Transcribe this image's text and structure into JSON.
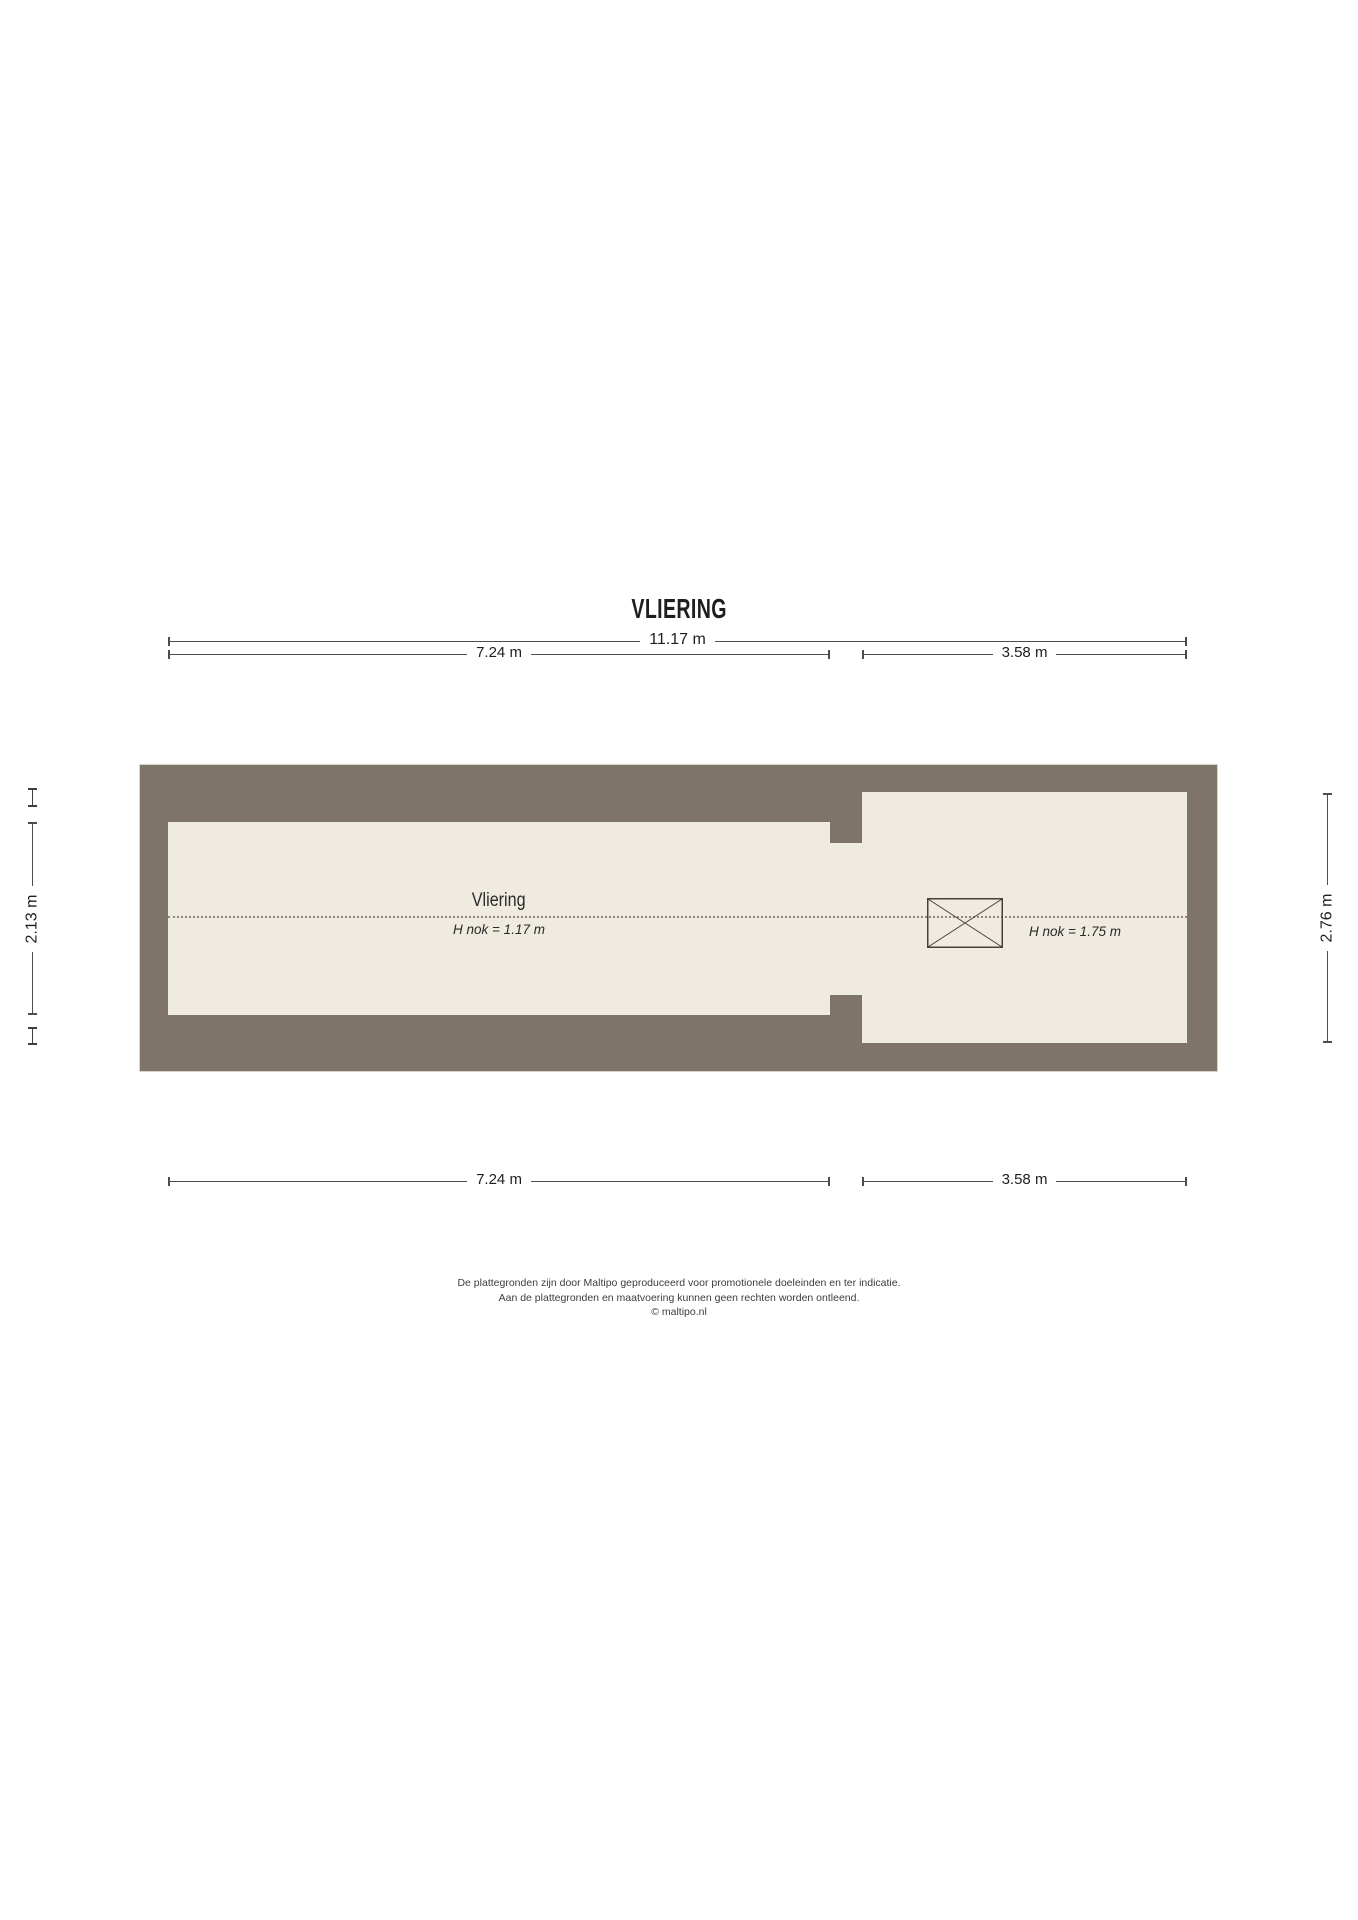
{
  "title": "VLIERING",
  "colors": {
    "wall": "#7e7468",
    "floor": "#f0ebe0",
    "dimension_line": "#4d4d4d",
    "ridge_dotted_line": "#8f897d",
    "text": "#1e1e1e"
  },
  "dimensions": {
    "top_total": "11.17 m",
    "top_left": "7.24 m",
    "top_right": "3.58 m",
    "bottom_left": "7.24 m",
    "bottom_right": "3.58 m",
    "side_left": "2.13 m",
    "side_right": "2.76 m"
  },
  "rooms": {
    "vliering": {
      "label": "Vliering",
      "ridge_height": "H nok = 1.17 m"
    },
    "right_area": {
      "ridge_height": "H nok = 1.75 m"
    }
  },
  "symbols": {
    "roof_window": "crossed-rectangle roof window / hatch symbol"
  },
  "footer": {
    "line1": "De plattegronden zijn door Maltipo geproduceerd voor promotionele doeleinden en ter indicatie.",
    "line2": "Aan de plattegronden en maatvoering kunnen geen rechten worden ontleend.",
    "line3": "© maltipo.nl"
  }
}
